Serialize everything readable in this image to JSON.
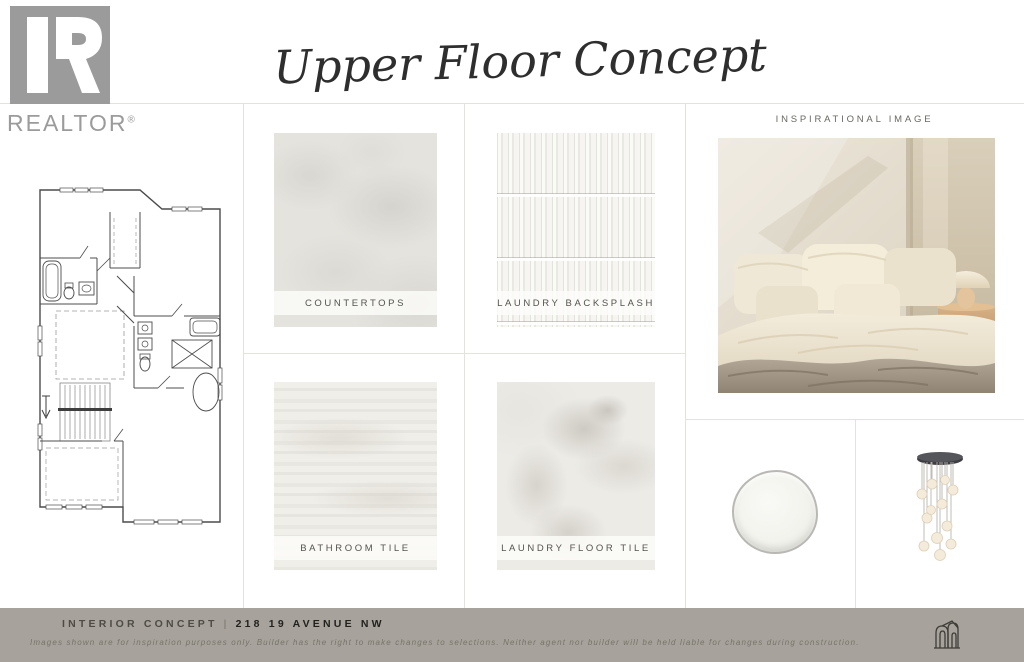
{
  "brand": {
    "name": "REALTOR",
    "reg": "®"
  },
  "title": "Upper Floor Concept",
  "inspiration": {
    "header": "INSPIRATIONAL IMAGE"
  },
  "swatches": [
    {
      "label": "COUNTERTOPS"
    },
    {
      "label": "LAUNDRY BACKSPLASH"
    },
    {
      "label": "BATHROOM TILE"
    },
    {
      "label": "LAUNDRY FLOOR TILE"
    }
  ],
  "footer": {
    "label": "INTERIOR CONCEPT",
    "separator": "|",
    "address": "218 19 AVENUE NW",
    "disclaimer": "Images shown are for inspiration purposes only. Builder has the right to make changes to selections. Neither agent nor builder will be held liable for changes during construction."
  },
  "colors": {
    "footer_bar": "#a7a39c",
    "grid_line": "#e4e2dd",
    "logo_gray": "#9b9b9b",
    "accent_cream": "#f1ead9",
    "accent_taupe": "#a99f91"
  }
}
